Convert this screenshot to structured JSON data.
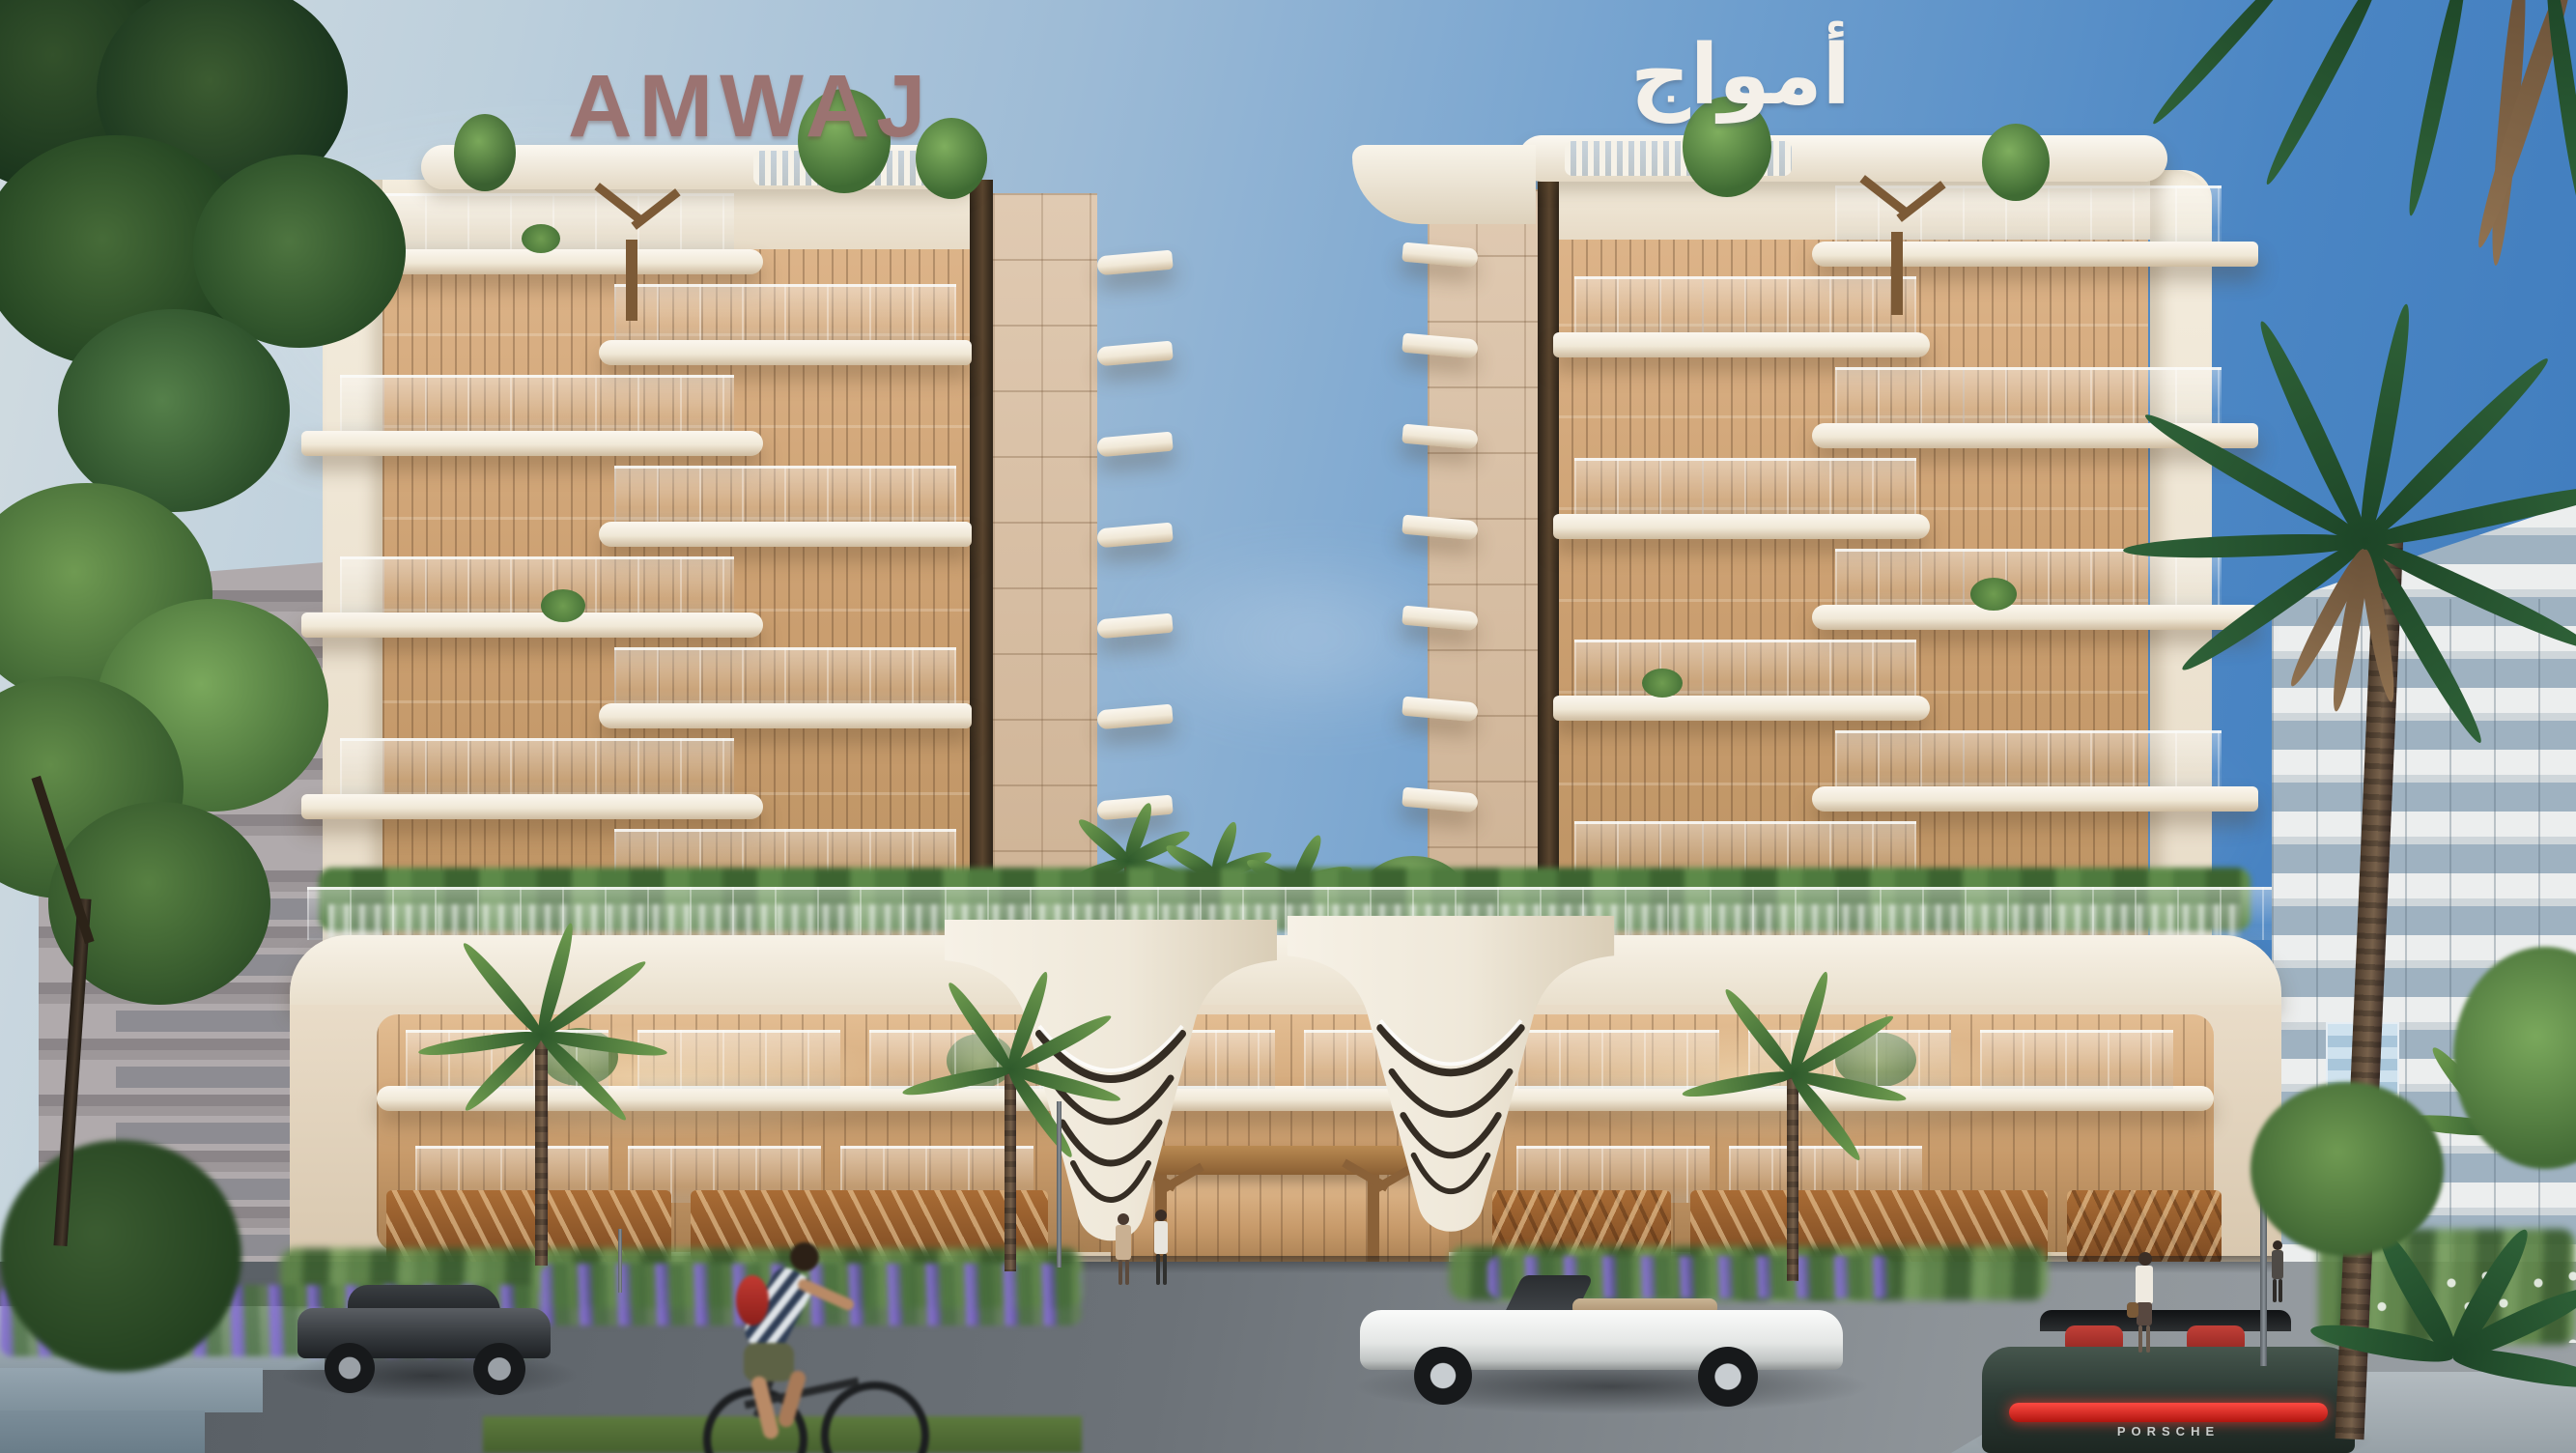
{
  "scene": {
    "description": "Daytime architectural rendering of the Amwaj twin residential towers: cream towers with stacked curved balconies and amber glass, a shared podium with sculpted V-shaped white legs, wavy copper wood screens, palm landscaping, cars and people on the street in front.",
    "signs": {
      "left_tower": "AMWAJ",
      "right_tower": "أمواج",
      "car_badge": "PORSCHE"
    },
    "palette": {
      "sky_left": "#d2dce1",
      "sky_right": "#3d7abc",
      "facade_cream": "#f4edde",
      "glass_amber": "#cb9f70",
      "balcony_white": "#fbf7ef",
      "wood_copper": "#a96c35",
      "bronze_fin": "#2e2419",
      "foliage_green": "#3f6b33",
      "lavender_purple": "#8a79cf",
      "road_gray": "#6f757b",
      "sign_mauve": "#9b7371",
      "porsche_green": "#27342e",
      "seat_red": "#b23430"
    }
  }
}
